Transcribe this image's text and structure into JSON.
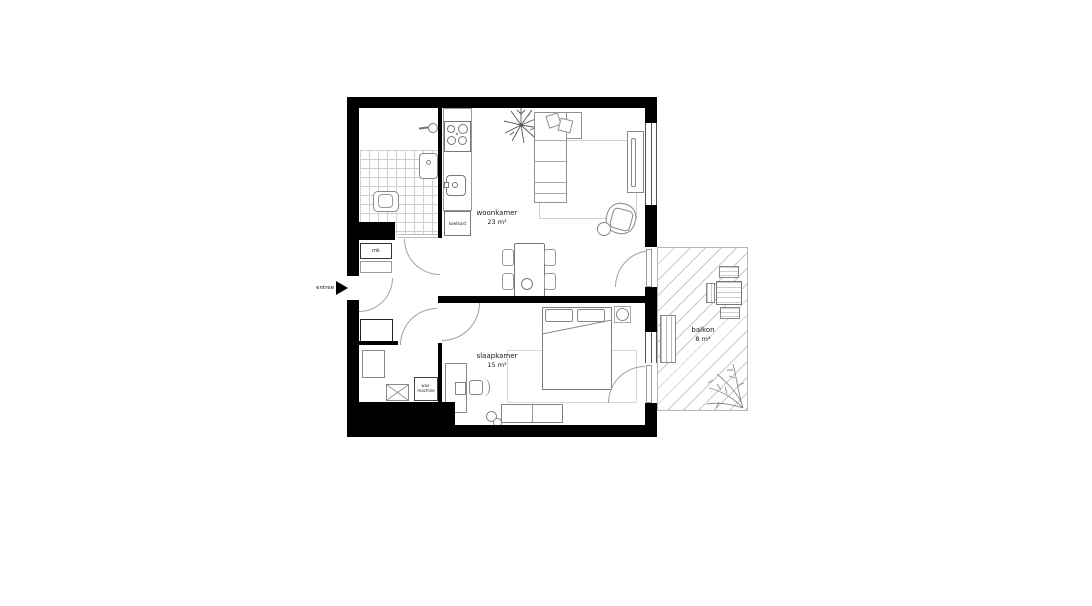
{
  "floorplan": {
    "type": "apartment floor plan",
    "rooms": [
      {
        "name": "woonkamer",
        "area": "23 m²"
      },
      {
        "name": "slaapkamer",
        "area": "15 m²"
      },
      {
        "name": "balkon",
        "area": "8 m²"
      }
    ],
    "annotations": {
      "entrance": "entree",
      "meter_cupboard": "mk",
      "fridge": "koelkast",
      "washing_machine": [
        "was-",
        "machine"
      ]
    },
    "colors": {
      "wall": "#000000",
      "fixture_line": "#8a8a8a",
      "hatch_line": "#c9c9c9",
      "background": "#ffffff"
    }
  }
}
